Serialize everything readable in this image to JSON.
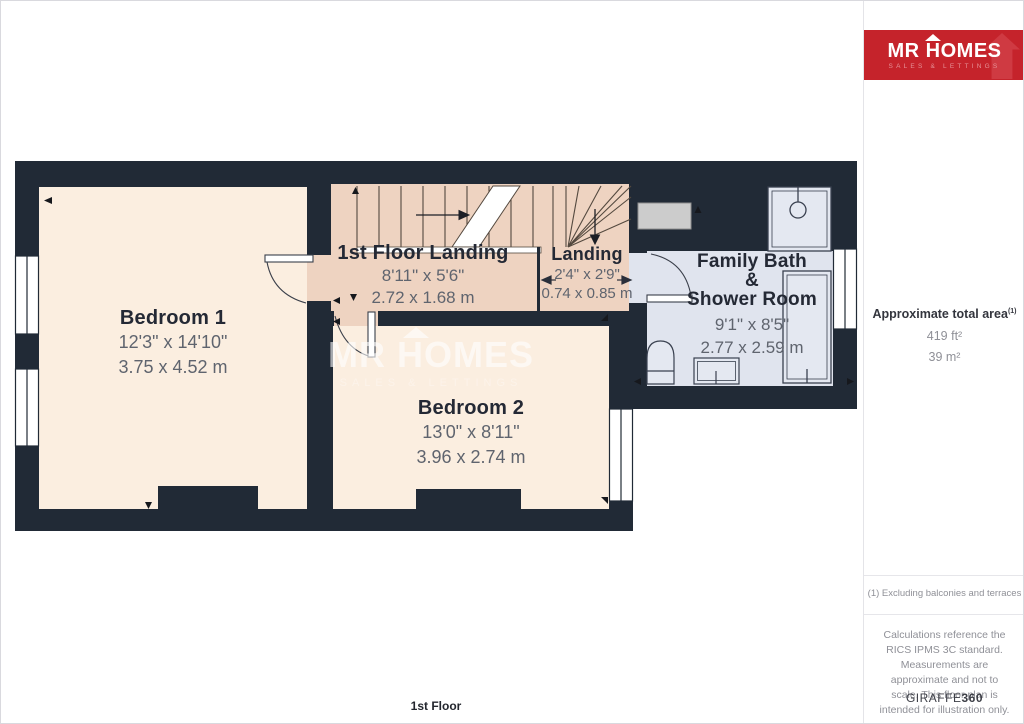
{
  "plan": {
    "floor_label": "1st Floor",
    "watermark": {
      "title": "MR HOMES",
      "tagline": "SALES & LETTINGS"
    },
    "rooms": {
      "bedroom1": {
        "name": "Bedroom 1",
        "imperial": "12'3\" x 14'10\"",
        "metric": "3.75 x 4.52 m"
      },
      "bedroom2": {
        "name": "Bedroom 2",
        "imperial": "13'0\" x 8'11\"",
        "metric": "3.96 x 2.74 m"
      },
      "landing_main": {
        "name": "1st Floor Landing",
        "imperial": "8'11\" x 5'6\"",
        "metric": "2.72 x 1.68 m"
      },
      "landing_small": {
        "name": "Landing",
        "imperial": "2'4\" x 2'9\"",
        "metric": "0.74 x 0.85 m"
      },
      "bathroom": {
        "name_line1": "Family Bath",
        "name_line2": "&",
        "name_line3": "Shower Room",
        "imperial": "9'1\" x 8'5\"",
        "metric": "2.77 x 2.59 m"
      }
    }
  },
  "sidebar": {
    "logo": {
      "title": "MR HOMES",
      "tagline": "SALES & LETTINGS"
    },
    "area": {
      "label": "Approximate total area",
      "footnote_marker": "(1)",
      "imperial": "419 ft²",
      "metric": "39 m²"
    },
    "footnote": "(1) Excluding balconies and terraces",
    "disclaimer": "Calculations reference the RICS IPMS 3C standard. Measurements are approximate and not to scale. This floor plan is intended for illustration only.",
    "brand": {
      "name": "GIRAFFE",
      "suffix": "360"
    }
  },
  "colors": {
    "wall": "#212a36",
    "bedroom_floor": "#fbeee0",
    "landing_floor": "#eed3c1",
    "bathroom_floor": "#e0e4ee",
    "brand_red": "#c5232b"
  }
}
